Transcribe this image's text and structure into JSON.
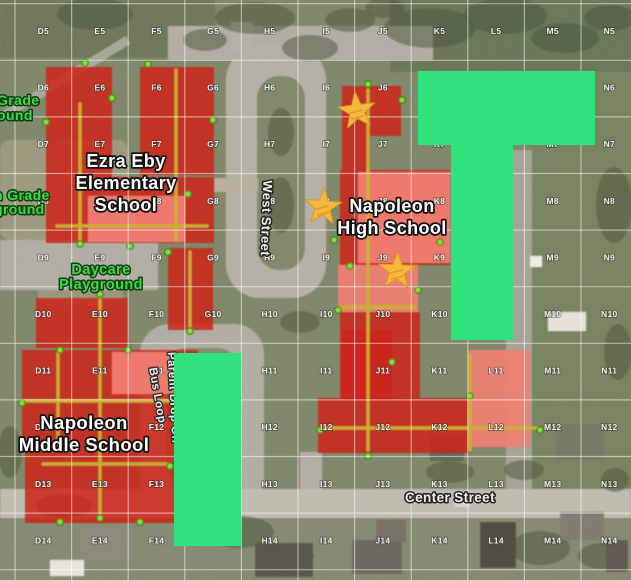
{
  "map": {
    "canvas": {
      "width": 631,
      "height": 580
    },
    "base_color": "#7E8767",
    "grid": {
      "columns": [
        "D",
        "E",
        "F",
        "G",
        "H",
        "I",
        "J",
        "K",
        "L",
        "M",
        "N"
      ],
      "rows": [
        5,
        6,
        7,
        8,
        9,
        10,
        11,
        12,
        13,
        14
      ],
      "label_origin": {
        "x": 43.3,
        "y": 34
      },
      "step": 56.6,
      "line_origin": {
        "x": 15,
        "y": 3.7
      },
      "line_color": "rgba(255,255,255,0.5)",
      "label_color": "#F2F1EA"
    },
    "zones": [
      {
        "name": "highlight-zone-t-shape",
        "points": "418,71 595,71 595,145 513,145 513,340 451,340 451,145 418,145"
      },
      {
        "name": "highlight-zone-bar",
        "points": "174,353 241,353 241,546 174,546"
      }
    ],
    "zone_color": "#2FE27C",
    "stars": {
      "fill": "#F5B83D",
      "stroke": "#DA9A1E",
      "points": [
        {
          "x": 357,
          "y": 111,
          "rot": -0.12
        },
        {
          "x": 323,
          "y": 207,
          "rot": 0.08
        },
        {
          "x": 397,
          "y": 271,
          "rot": 0.05
        }
      ]
    },
    "buildings": {
      "red_color": "#CE251B",
      "highlight_color": "#F17F73",
      "corridor_color": "#CBB031",
      "dot_fill": "#86E03C",
      "dot_stroke": "#2F7D10",
      "red": [
        {
          "points": "46,67 112,67 112,177 46,177"
        },
        {
          "points": "140,67 214,67 214,175 140,175"
        },
        {
          "points": "46,177 214,177 214,243 46,243"
        },
        {
          "points": "168,248 213,248 213,330 168,330"
        },
        {
          "points": "36,298 128,298 128,348 36,348"
        },
        {
          "points": "22,350 198,350 198,446 22,446"
        },
        {
          "points": "25,446 178,446 178,523 25,523"
        },
        {
          "points": "342,86 401,86 401,136 368,136 368,172 342,172"
        },
        {
          "points": "340,170 450,170 450,265 340,265"
        },
        {
          "points": "340,312 420,312 420,398 340,398"
        },
        {
          "points": "318,398 470,398 470,453 318,453"
        },
        {
          "points": "342,330 392,330 392,400 342,400"
        }
      ],
      "highlight": [
        {
          "points": "88,196 185,196 185,242 88,242"
        },
        {
          "points": "112,352 174,352 174,394 112,394"
        },
        {
          "points": "358,172 450,172 450,263 358,263"
        },
        {
          "points": "338,265 418,265 418,312 338,312"
        },
        {
          "points": "468,350 530,350 530,447 468,447"
        }
      ],
      "corridors": [
        [
          80,
          104,
          80,
          240
        ],
        [
          57,
          226,
          207,
          226
        ],
        [
          176,
          70,
          176,
          240
        ],
        [
          190,
          252,
          190,
          327
        ],
        [
          100,
          300,
          100,
          515
        ],
        [
          25,
          401,
          195,
          401
        ],
        [
          58,
          353,
          58,
          444
        ],
        [
          43,
          464,
          168,
          464
        ],
        [
          368,
          90,
          368,
          450
        ],
        [
          340,
          307,
          414,
          307
        ],
        [
          320,
          428,
          538,
          428
        ],
        [
          470,
          356,
          470,
          450
        ]
      ],
      "entrance_dots": [
        [
          85,
          63
        ],
        [
          148,
          64
        ],
        [
          112,
          98
        ],
        [
          213,
          120
        ],
        [
          46,
          122
        ],
        [
          80,
          244
        ],
        [
          188,
          194
        ],
        [
          130,
          246
        ],
        [
          168,
          252
        ],
        [
          190,
          331
        ],
        [
          100,
          294
        ],
        [
          128,
          350
        ],
        [
          60,
          350
        ],
        [
          22,
          403
        ],
        [
          196,
          403
        ],
        [
          100,
          518
        ],
        [
          60,
          522
        ],
        [
          140,
          522
        ],
        [
          170,
          466
        ],
        [
          368,
          84
        ],
        [
          402,
          100
        ],
        [
          334,
          240
        ],
        [
          350,
          266
        ],
        [
          440,
          242
        ],
        [
          456,
          262
        ],
        [
          418,
          290
        ],
        [
          368,
          456
        ],
        [
          320,
          430
        ],
        [
          470,
          396
        ],
        [
          540,
          430
        ],
        [
          392,
          362
        ],
        [
          338,
          310
        ]
      ]
    },
    "text_labels": [
      {
        "name": "elementary-school-label",
        "lines": [
          "Ezra Eby",
          "Elementary",
          "School"
        ],
        "x": 126,
        "y": [
          167,
          189,
          211
        ],
        "size": 18,
        "fill": "#FFFFFF",
        "stroke": "#111111",
        "sw": 3.4
      },
      {
        "name": "high-school-label",
        "lines": [
          "Napoleon",
          "High School"
        ],
        "x": 392,
        "y": [
          212,
          234
        ],
        "size": 18,
        "fill": "#FFFFFF",
        "stroke": "#111111",
        "sw": 3.4
      },
      {
        "name": "middle-school-label",
        "lines": [
          "Napoleon",
          "Middle School"
        ],
        "x": 84,
        "y": [
          429,
          451
        ],
        "size": 18.5,
        "fill": "#FFFFFF",
        "stroke": "#111111",
        "sw": 3.4
      },
      {
        "name": "center-street-label",
        "lines": [
          "Center Street"
        ],
        "x": 450,
        "y": [
          502
        ],
        "size": 13.5,
        "fill": "#F2F1EC",
        "stroke": "#222222",
        "sw": 3
      },
      {
        "name": "west-street-label",
        "lines": [
          "West Street"
        ],
        "x": 262,
        "y": [
          218
        ],
        "size": 13,
        "fill": "#F2F1EC",
        "stroke": "#222222",
        "sw": 3,
        "rotate": 92
      },
      {
        "name": "parent-drop-off-label",
        "lines": [
          "Parent Drop Off"
        ],
        "x": 170,
        "y": [
          398
        ],
        "size": 11.5,
        "fill": "#EFEEE9",
        "stroke": "#2A2A2A",
        "sw": 2.6,
        "rotate": 87
      },
      {
        "name": "bus-loop-label",
        "lines": [
          "Bus Loop"
        ],
        "x": 154,
        "y": [
          396
        ],
        "size": 11.5,
        "fill": "#EFEEE9",
        "stroke": "#2A2A2A",
        "sw": 2.6,
        "rotate": 80
      },
      {
        "name": "daycare-playground-label",
        "lines": [
          "Daycare",
          "Playground"
        ],
        "x": 101,
        "y": [
          274,
          289
        ],
        "size": 14.5,
        "fill": "#3FD848",
        "stroke": "#123D0E",
        "sw": 3
      },
      {
        "name": "grade-playground-label-top",
        "lines": [
          "Grade",
          "ound"
        ],
        "x": -3,
        "y": [
          105,
          120
        ],
        "size": 14,
        "fill": "#3FD848",
        "stroke": "#123D0E",
        "sw": 3,
        "anchor": "start"
      },
      {
        "name": "grade-playground-label-left",
        "lines": [
          "n Grade",
          "ground"
        ],
        "x": -6,
        "y": [
          200,
          214
        ],
        "size": 14,
        "fill": "#3FD848",
        "stroke": "#123D0E",
        "sw": 3,
        "anchor": "start"
      }
    ],
    "scenery": {
      "patches": [
        {
          "x": 0,
          "y": 0,
          "w": 215,
          "h": 58,
          "fill": "#5C6A4C",
          "op": 0.55
        },
        {
          "x": 390,
          "y": 0,
          "w": 241,
          "h": 72,
          "fill": "#59684B",
          "op": 0.6
        },
        {
          "x": 530,
          "y": 72,
          "w": 101,
          "h": 440,
          "fill": "#6E7E55",
          "op": 0.5
        },
        {
          "x": 0,
          "y": 140,
          "w": 128,
          "h": 100,
          "fill": "#B5A890",
          "op": 0.55,
          "rx": 10
        },
        {
          "x": 38,
          "y": 248,
          "w": 85,
          "h": 58,
          "fill": "#B3A58F",
          "op": 0.5,
          "rx": 8
        },
        {
          "x": 0,
          "y": 520,
          "w": 631,
          "h": 60,
          "fill": "#8F8B7E",
          "op": 0.35
        }
      ],
      "roads": [
        {
          "kind": "rect",
          "x": 168,
          "y": 26,
          "w": 265,
          "h": 34,
          "fill": "#B2AEA4"
        },
        {
          "kind": "rect",
          "x": 231,
          "y": 22,
          "w": 22,
          "h": 30,
          "fill": "#B5B1A7"
        },
        {
          "kind": "rrect",
          "x": 226,
          "y": 46,
          "w": 100,
          "h": 252,
          "rx": 34,
          "fill": "#B5B1A7"
        },
        {
          "kind": "rrect",
          "x": 257,
          "y": 76,
          "w": 48,
          "h": 194,
          "rx": 22,
          "fill": "#7F8868"
        },
        {
          "kind": "rect",
          "x": 0,
          "y": 240,
          "w": 158,
          "h": 50,
          "fill": "#B2AEA4"
        },
        {
          "kind": "rect",
          "x": 214,
          "y": 178,
          "w": 44,
          "h": 14,
          "fill": "#BAAE9C"
        },
        {
          "kind": "rrect",
          "x": 140,
          "y": 324,
          "w": 124,
          "h": 184,
          "rx": 30,
          "fill": "#B1ADA3"
        },
        {
          "kind": "rrect",
          "x": 166,
          "y": 348,
          "w": 72,
          "h": 136,
          "rx": 20,
          "fill": "#838C6B"
        },
        {
          "kind": "rect",
          "x": 506,
          "y": 150,
          "w": 26,
          "h": 342,
          "fill": "#ACA89D",
          "op": 0.85
        },
        {
          "kind": "rect",
          "x": 300,
          "y": 452,
          "w": 22,
          "h": 40,
          "fill": "#B2AEA4"
        },
        {
          "kind": "rect",
          "x": 0,
          "y": 489,
          "w": 631,
          "h": 29,
          "fill": "#C0BCB0"
        },
        {
          "kind": "line",
          "x1": 0,
          "y1": 118,
          "x2": 128,
          "y2": 40,
          "w": 9,
          "fill": "#B7B3A8",
          "op": 0.8
        }
      ],
      "trees": [
        [
          95,
          14,
          38,
          16
        ],
        [
          255,
          18,
          40,
          16
        ],
        [
          310,
          48,
          28,
          13
        ],
        [
          205,
          40,
          22,
          11
        ],
        [
          430,
          28,
          46,
          20
        ],
        [
          505,
          16,
          42,
          18
        ],
        [
          565,
          38,
          34,
          15
        ],
        [
          610,
          18,
          26,
          13
        ],
        [
          614,
          205,
          18,
          38
        ],
        [
          618,
          352,
          14,
          28
        ],
        [
          300,
          322,
          20,
          11
        ],
        [
          240,
          532,
          34,
          16
        ],
        [
          286,
          556,
          28,
          13
        ],
        [
          540,
          548,
          30,
          17
        ],
        [
          602,
          556,
          24,
          13
        ],
        [
          450,
          472,
          24,
          11
        ],
        [
          524,
          470,
          20,
          10
        ],
        [
          205,
          508,
          22,
          10
        ],
        [
          64,
          506,
          28,
          12
        ],
        [
          281,
          132,
          13,
          24
        ],
        [
          281,
          205,
          13,
          28
        ],
        [
          10,
          452,
          12,
          26
        ],
        [
          615,
          480,
          14,
          12
        ],
        [
          350,
          20,
          25,
          12
        ],
        [
          385,
          8,
          20,
          10
        ]
      ],
      "houses": [
        {
          "x": 80,
          "y": 525,
          "w": 52,
          "h": 38,
          "fill": "#8B8778"
        },
        {
          "x": 255,
          "y": 543,
          "w": 58,
          "h": 34,
          "fill": "#57524A"
        },
        {
          "x": 352,
          "y": 540,
          "w": 50,
          "h": 34,
          "fill": "#6B665C"
        },
        {
          "x": 480,
          "y": 522,
          "w": 36,
          "h": 46,
          "fill": "#4E493F"
        },
        {
          "x": 560,
          "y": 512,
          "w": 44,
          "h": 28,
          "fill": "#7E7A6E"
        },
        {
          "x": 606,
          "y": 540,
          "w": 22,
          "h": 32,
          "fill": "#5E594F"
        },
        {
          "x": 556,
          "y": 424,
          "w": 48,
          "h": 36,
          "fill": "#6F7A64"
        },
        {
          "x": 430,
          "y": 435,
          "w": 34,
          "h": 26,
          "fill": "#5C6650"
        },
        {
          "x": 376,
          "y": 520,
          "w": 30,
          "h": 22,
          "fill": "#757065"
        },
        {
          "x": 50,
          "y": 560,
          "w": 34,
          "h": 16,
          "fill": "#E8E6DE"
        },
        {
          "x": 548,
          "y": 312,
          "w": 38,
          "h": 19,
          "fill": "#E6E4DB"
        },
        {
          "x": 530,
          "y": 256,
          "w": 12,
          "h": 11,
          "fill": "#EFEEE8"
        },
        {
          "x": 455,
          "y": 498,
          "w": 15,
          "h": 9,
          "fill": "#D8D6CE"
        }
      ]
    }
  }
}
